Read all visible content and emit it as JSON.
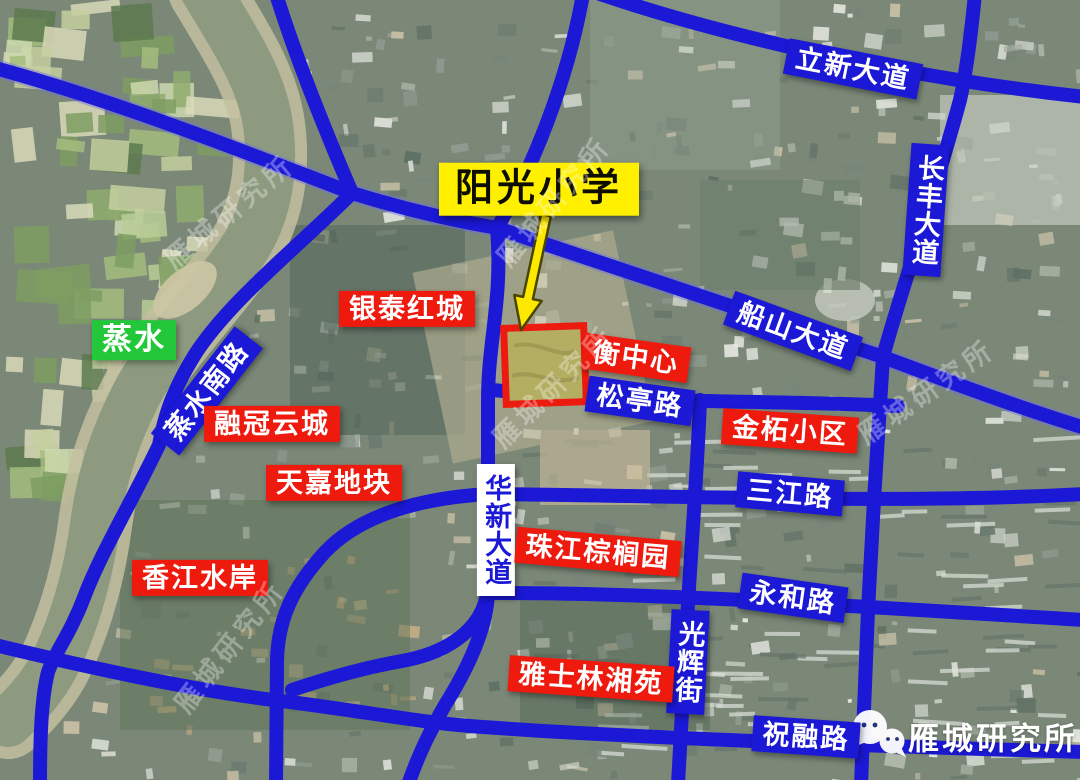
{
  "map": {
    "colors": {
      "road_blue": "#1b18d6",
      "label_red": "#ee1a0e",
      "label_blue": "#1b18d6",
      "label_green": "#22c73a",
      "label_yellow": "#fff000",
      "parcel_border": "#ed1a0f",
      "parcel_fill": "#b3ae62",
      "river": "#8d9a80",
      "arrow_yellow": "#ffe800"
    },
    "labels": {
      "yangguang": {
        "text": "阳光小学",
        "type": "highlight-poi"
      },
      "lixin": {
        "text": "立新大道",
        "type": "road"
      },
      "changfeng": {
        "text": "长丰大道",
        "type": "road"
      },
      "chuanshan": {
        "text": "船山大道",
        "type": "road"
      },
      "zhengshui": {
        "text": "蒸水",
        "type": "river"
      },
      "zhengshuinan": {
        "text": "蒸水南路",
        "type": "road"
      },
      "yintai": {
        "text": "银泰红城",
        "type": "poi"
      },
      "rongguan": {
        "text": "融冠云城",
        "type": "poi"
      },
      "tianjia": {
        "text": "天嘉地块",
        "type": "poi"
      },
      "xiangjiang": {
        "text": "香江水岸",
        "type": "poi"
      },
      "huaxin": {
        "text": "华新大道",
        "type": "road"
      },
      "hengzhongxin": {
        "text": "衡中心",
        "type": "poi"
      },
      "songting": {
        "text": "松亭路",
        "type": "road"
      },
      "jinzhe": {
        "text": "金柘小区",
        "type": "poi"
      },
      "sanjiang": {
        "text": "三江路",
        "type": "road"
      },
      "zhujiang": {
        "text": "珠江棕榈园",
        "type": "poi"
      },
      "yonghe": {
        "text": "永和路",
        "type": "road"
      },
      "guanghui": {
        "text": "光辉街",
        "type": "road"
      },
      "yashilin": {
        "text": "雅士林湘苑",
        "type": "poi"
      },
      "zhurong": {
        "text": "祝融路",
        "type": "road"
      }
    },
    "watermark": {
      "text": "雁城研究所"
    },
    "brand": {
      "text": "雁城研究所",
      "icon": "wechat-icon"
    }
  }
}
